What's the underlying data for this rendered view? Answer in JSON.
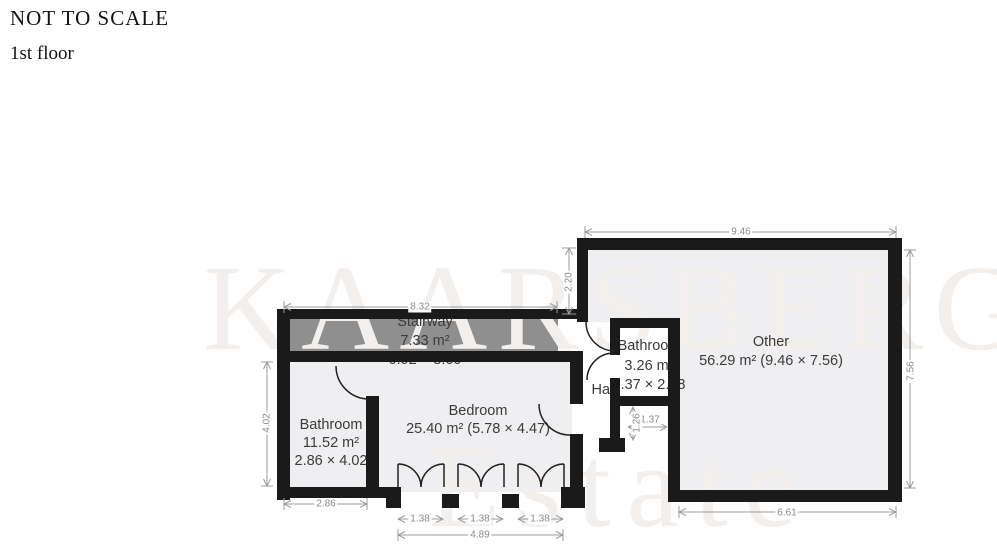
{
  "header": {
    "not_to_scale": "NOT TO SCALE",
    "floor": "1st floor"
  },
  "watermark": {
    "top": "KAARSBERG",
    "bottom": "Estate"
  },
  "rooms": {
    "stairway": {
      "name": "Stairway",
      "area": "7.33 m²",
      "size": "0.92 × 8.00"
    },
    "bathroom_left": {
      "name": "Bathroom",
      "area": "11.52 m²",
      "size": "2.86 × 4.02"
    },
    "bedroom": {
      "name": "Bedroom",
      "area_size": "25.40 m² (5.78 × 4.47)"
    },
    "hall": {
      "name": "Hall"
    },
    "bathroom_right": {
      "name": "Bathroom",
      "area": "3.26 m²",
      "size": "1.37 × 2.38"
    },
    "other": {
      "name": "Other",
      "area_size": "56.29 m² (9.46 × 7.56)"
    }
  },
  "dimensions": {
    "stairway_top": "8.32",
    "other_top": "9.46",
    "other_left_height": "2.20",
    "other_right_height": "7.56",
    "other_bottom": "6.61",
    "bathroom_left_width": "2.86",
    "bathroom_left_height": "4.02",
    "door_1": "1.38",
    "door_2": "1.38",
    "door_3": "1.38",
    "doors_total": "4.89",
    "nook_width": "1.37",
    "nook_height": "1.26"
  },
  "colors": {
    "wall": "#1a1a1a",
    "floor": "#efeff1",
    "stairway_fill": "#8f8f8f",
    "dimension": "#8b8b8b",
    "room_label": "#3b3b3b",
    "watermark": "#f2efec"
  }
}
